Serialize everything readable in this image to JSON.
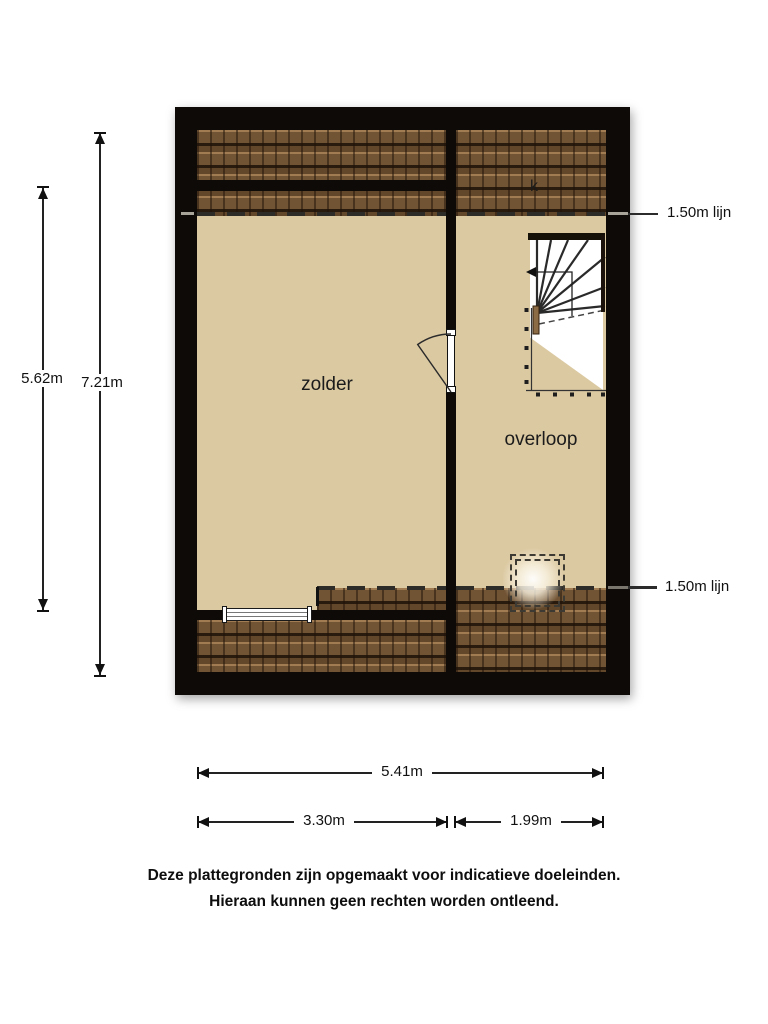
{
  "rooms": [
    {
      "label": "zolder"
    },
    {
      "label": "overloop"
    }
  ],
  "closet_label": "k",
  "height_lines": {
    "top": "1.50m lijn",
    "bottom": "1.50m lijn"
  },
  "dimensions": {
    "vertical_inner": "5.62m",
    "vertical_outer": "7.21m",
    "horizontal_total": "5.41m",
    "horizontal_left": "3.30m",
    "horizontal_right": "1.99m"
  },
  "disclaimer": {
    "line1": "Deze plattegronden zijn opgemaakt voor indicatieve doeleinden.",
    "line2": "Hieraan kunnen geen rechten worden ontleend."
  },
  "colors": {
    "wall": "#0d0a07",
    "floor": "#dbc9a2",
    "roof_tile": "#6f5233",
    "dash_line": "#2e2c28",
    "dimension": "#111111",
    "stair_wood": "#8b6a46"
  }
}
